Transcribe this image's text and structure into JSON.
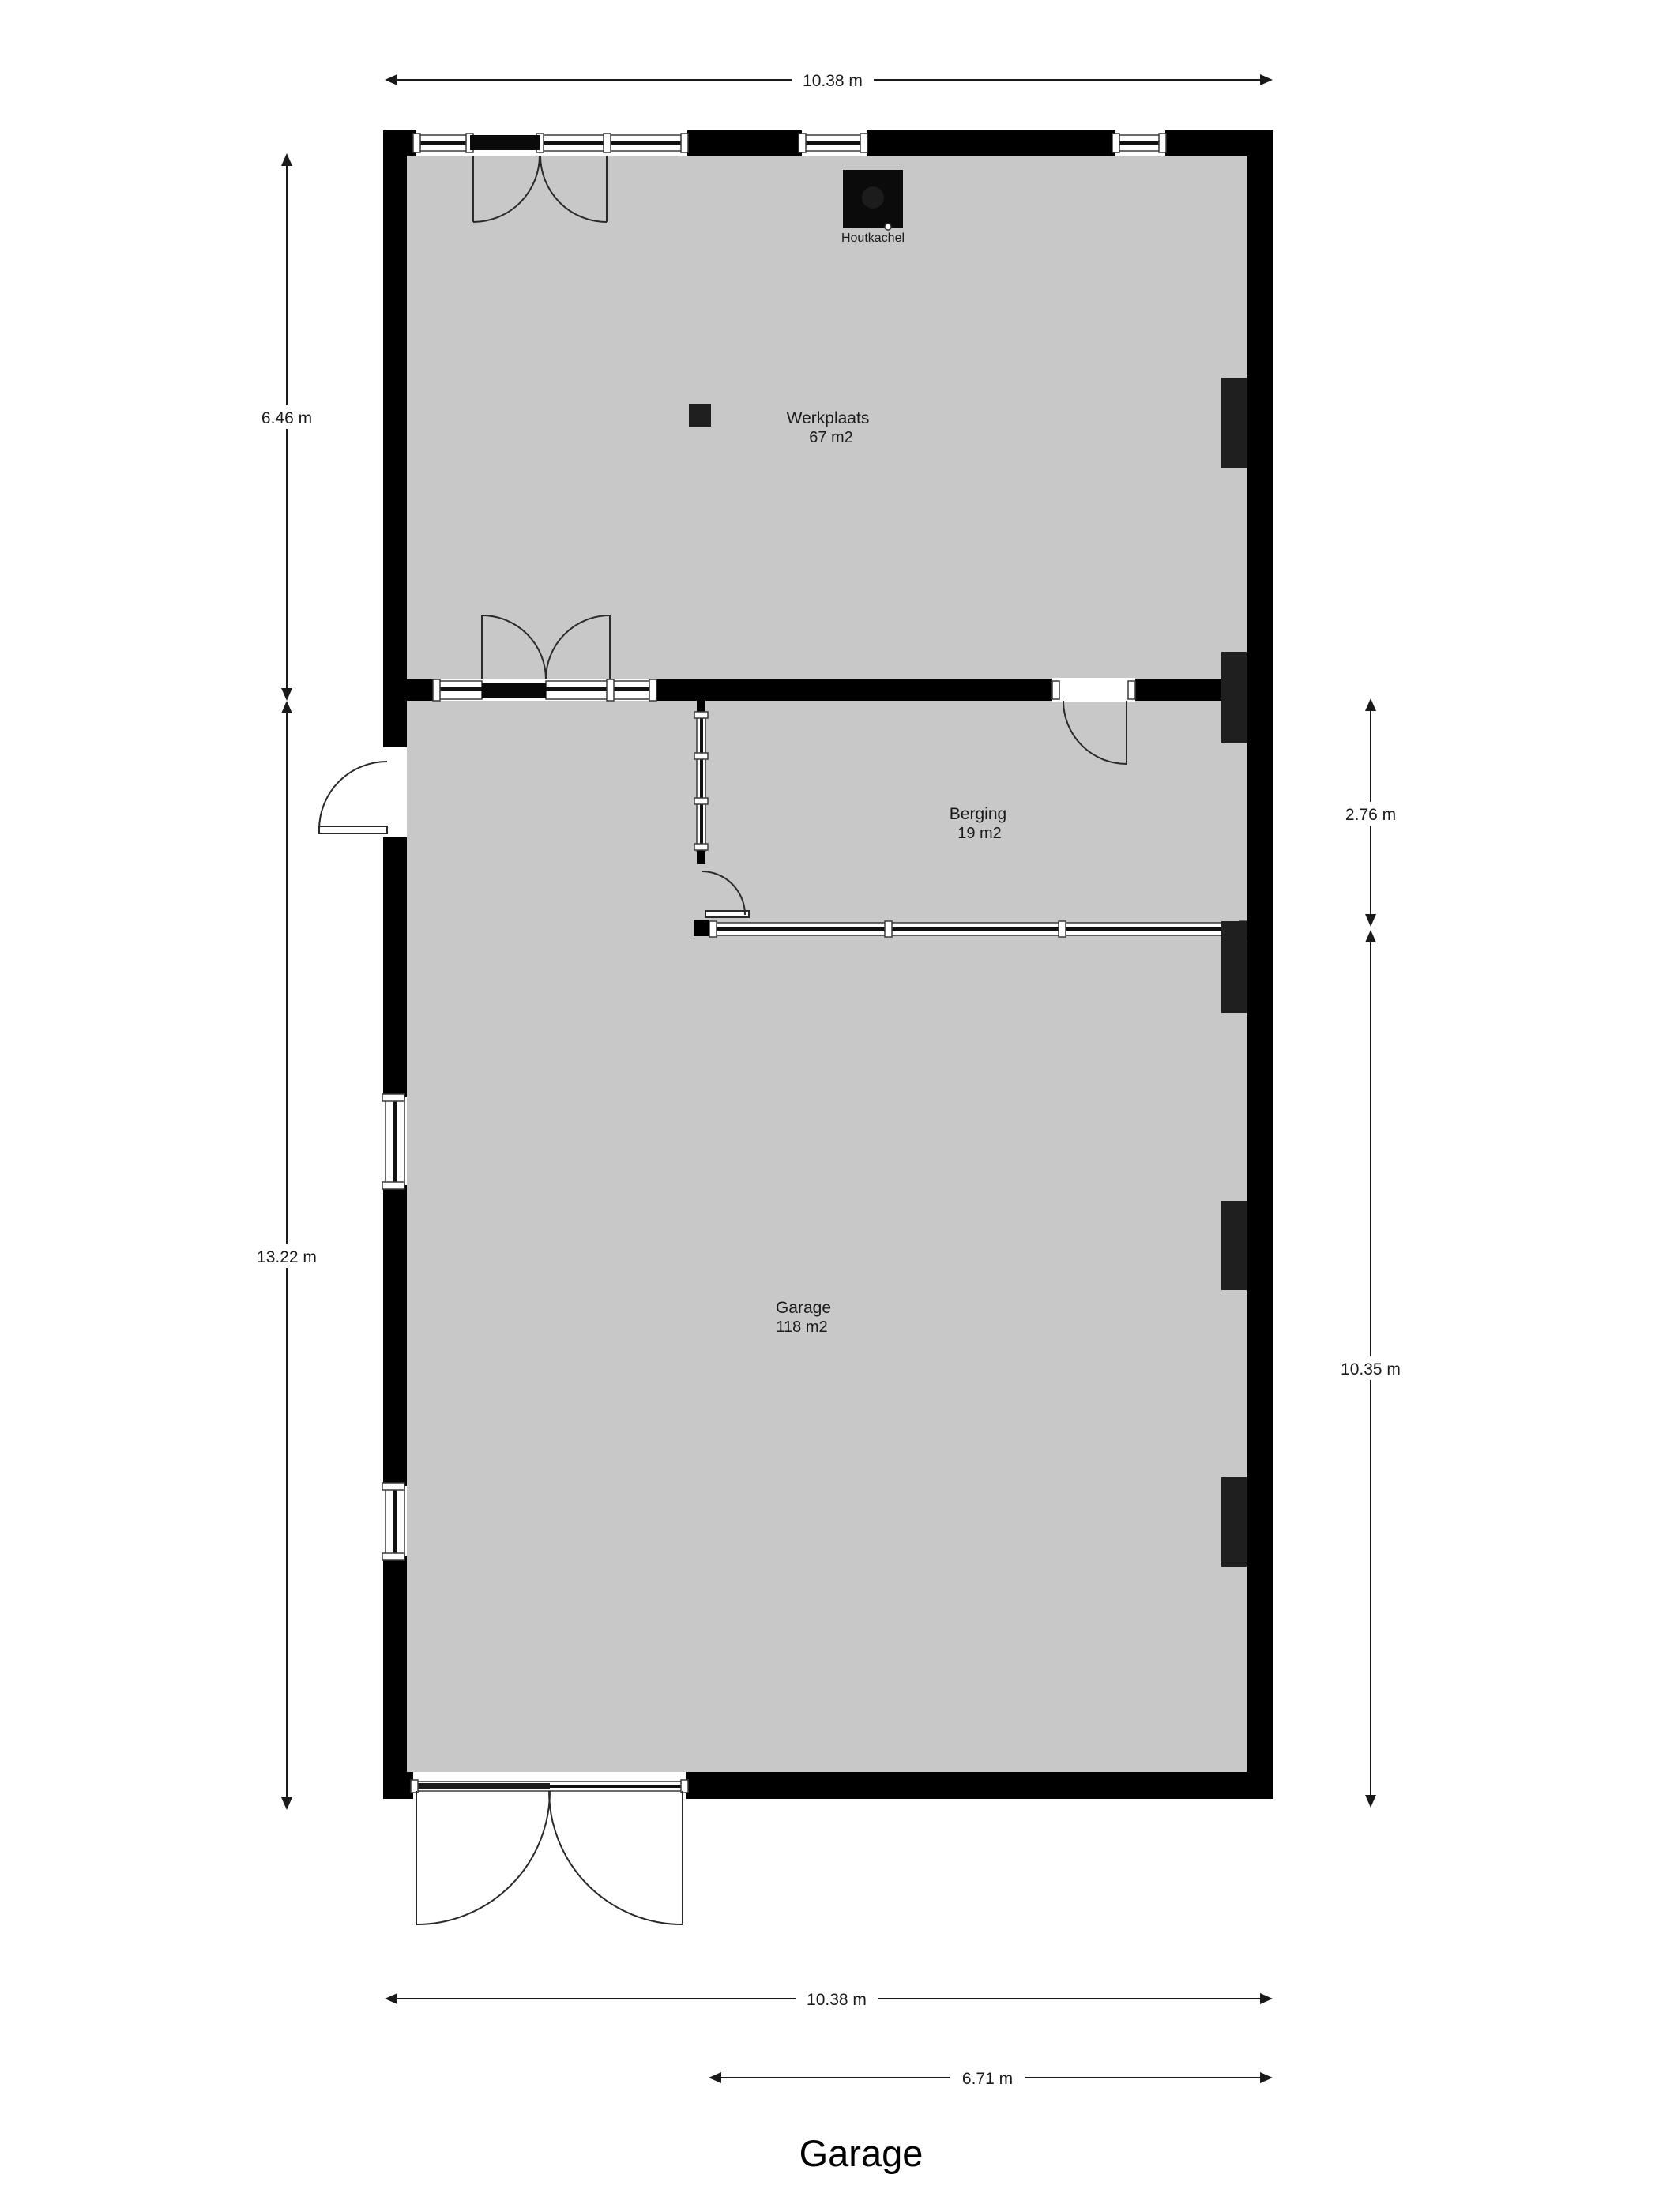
{
  "title": "Garage",
  "rooms": [
    {
      "name": "Werkplaats",
      "area": "67 m2"
    },
    {
      "name": "Berging",
      "area": "19 m2"
    },
    {
      "name": "Garage",
      "area": "118 m2"
    }
  ],
  "fixtures": {
    "stove_label": "Houtkachel"
  },
  "dimensions": {
    "top": "10.38 m",
    "left_upper": "6.46 m",
    "left_lower": "13.22 m",
    "right_upper": "2.76 m",
    "right_lower": "10.35 m",
    "bottom_full": "10.38 m",
    "bottom_partial": "6.71 m"
  },
  "colors": {
    "background": "#ffffff",
    "floor": "#c8c8c8",
    "wall": "#000000",
    "pilaster": "#1f1f1f",
    "line": "#1a1a1a"
  }
}
